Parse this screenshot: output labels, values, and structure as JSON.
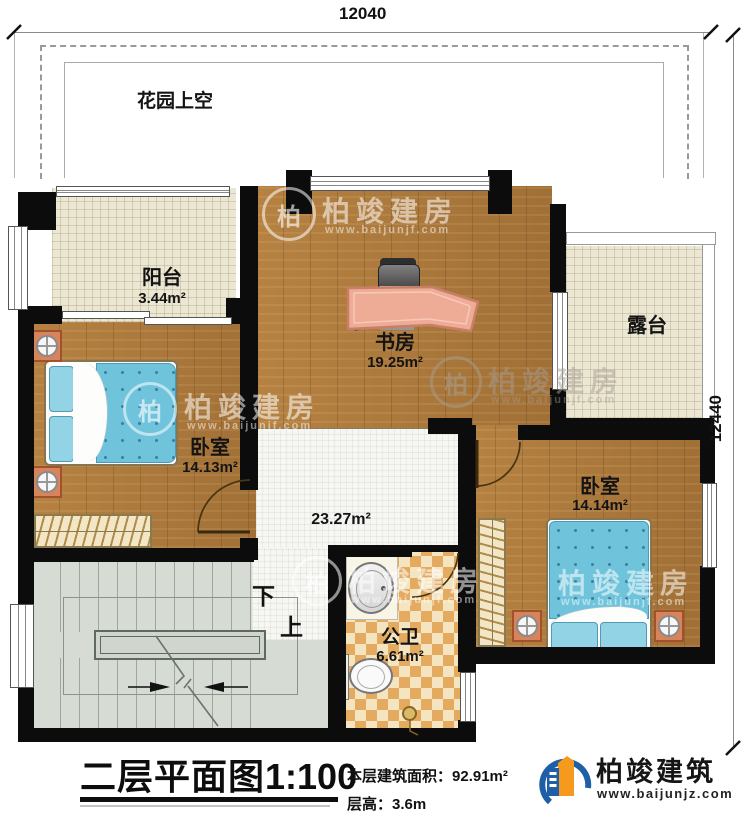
{
  "dimensions": {
    "width_top": "12040",
    "height_right": "12440"
  },
  "garden": {
    "label": "花园上空"
  },
  "rooms": {
    "balcony": {
      "name": "阳台",
      "area": "3.44m²"
    },
    "study": {
      "name": "书房",
      "area": "19.25m²"
    },
    "terrace": {
      "name": "露台"
    },
    "bedroom_left": {
      "name": "卧室",
      "area": "14.13m²"
    },
    "bedroom_right": {
      "name": "卧室",
      "area": "14.14m²"
    },
    "hall": {
      "area": "23.27m²"
    },
    "bathroom": {
      "name": "公卫",
      "area": "6.61m²"
    },
    "stairs": {
      "down": "下",
      "up": "上"
    }
  },
  "titleblock": {
    "title": "二层平面图",
    "scale": "1:100",
    "area_label": "本层建筑面积：",
    "area_value": "92.91m²",
    "height_label": "层高：",
    "height_value": "3.6m"
  },
  "brand": {
    "name": "柏竣建筑",
    "site": "www.baijunjz.com"
  },
  "watermark": {
    "name": "柏竣建房",
    "site": "www.baijunjf.com",
    "logo_char": "柏"
  },
  "colors": {
    "wall": "#0c0c0c",
    "wood": "#ad7a3c",
    "tile_cream": "#ece7d2",
    "checker_orange": "#e3aa60",
    "bed_blue": "#6fc4dc",
    "stairs_gray": "#d6dbd3",
    "brand_blue": "#1f5fa8",
    "brand_orange": "#f59a1d"
  }
}
